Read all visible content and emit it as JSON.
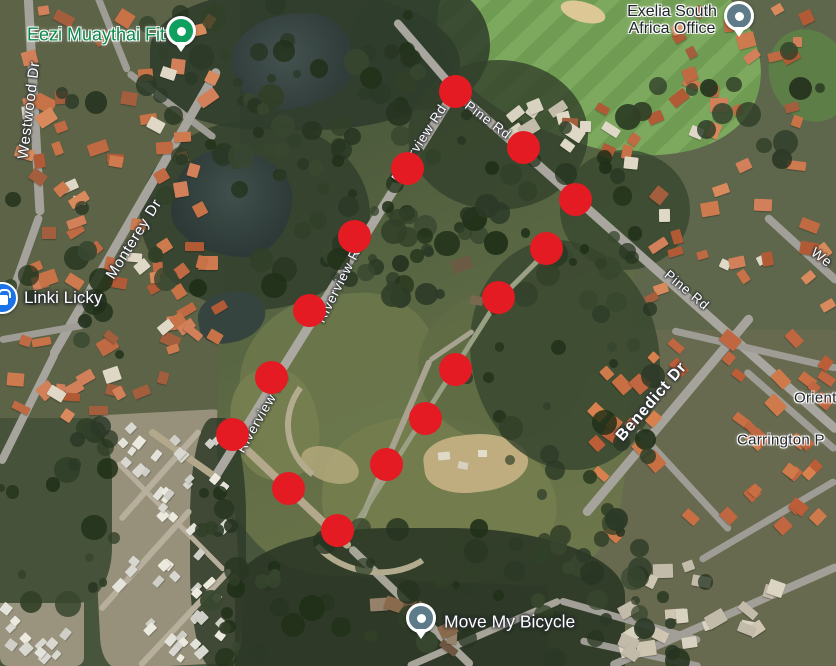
{
  "map_type": "satellite",
  "annotation": {
    "dot_color": "#e41b22",
    "dot_diameter": 33,
    "boundary_dots": [
      {
        "x": 455,
        "y": 91
      },
      {
        "x": 523,
        "y": 147
      },
      {
        "x": 575,
        "y": 199
      },
      {
        "x": 546,
        "y": 248
      },
      {
        "x": 498,
        "y": 297
      },
      {
        "x": 455,
        "y": 369
      },
      {
        "x": 425,
        "y": 418
      },
      {
        "x": 386,
        "y": 464
      },
      {
        "x": 337,
        "y": 530
      },
      {
        "x": 288,
        "y": 488
      },
      {
        "x": 232,
        "y": 434
      },
      {
        "x": 271,
        "y": 377
      },
      {
        "x": 309,
        "y": 310
      },
      {
        "x": 354,
        "y": 236
      },
      {
        "x": 407,
        "y": 168
      }
    ]
  },
  "road_labels": [
    {
      "text": "Westwood Dr",
      "x": 29,
      "y": 110,
      "rot": -83,
      "size": 15,
      "weight": 400
    },
    {
      "text": "Monterey Dr",
      "x": 134,
      "y": 239,
      "rot": -58,
      "size": 15,
      "weight": 400
    },
    {
      "text": "Riverview Rd",
      "x": 262,
      "y": 413,
      "rot": -60,
      "size": 13.5,
      "weight": 400
    },
    {
      "text": "Riverview Rd",
      "x": 340,
      "y": 282,
      "rot": -63,
      "size": 13.5,
      "weight": 400
    },
    {
      "text": "Riverview Rd",
      "x": 419,
      "y": 143,
      "rot": -57,
      "size": 13.5,
      "weight": 400
    },
    {
      "text": "Pine Rd",
      "x": 488,
      "y": 120,
      "rot": 37,
      "size": 13.5,
      "weight": 400
    },
    {
      "text": "Pine Rd",
      "x": 687,
      "y": 290,
      "rot": 40,
      "size": 13.5,
      "weight": 400
    },
    {
      "text": "Benedict Dr",
      "x": 652,
      "y": 402,
      "rot": -49,
      "size": 16,
      "weight": 600
    },
    {
      "text": "We",
      "x": 822,
      "y": 257,
      "rot": 37,
      "size": 14,
      "weight": 400
    }
  ],
  "place_labels": [
    {
      "text": "Orient",
      "x": 794,
      "y": 398,
      "size": 15
    },
    {
      "text": "Carrington P",
      "x": 737,
      "y": 440,
      "size": 15
    }
  ],
  "pois": [
    {
      "id": "eezi-muaythai-fit",
      "label": "Eezi Muaythai Fit",
      "label_color": "#0c8a4c",
      "size": 18,
      "marker": {
        "type": "pin",
        "color": "#0fa060",
        "x": 181,
        "y": 31
      },
      "label_pos": {
        "anchor": "right",
        "x": 165,
        "y": 35
      }
    },
    {
      "id": "linki-licky",
      "label": "Linki Licky",
      "label_color": "#ffffff",
      "size": 17,
      "marker": {
        "type": "circle",
        "color": "#1a73e8",
        "x": 2,
        "y": 298
      },
      "label_pos": {
        "anchor": "left",
        "x": 24,
        "y": 298
      }
    },
    {
      "id": "exelia-south-africa-office",
      "label_lines": [
        "Exelia South",
        "Africa Office"
      ],
      "label_color": "#20262b",
      "size": 16,
      "marker": {
        "type": "pin",
        "color": "#5d7b89",
        "x": 739,
        "y": 16
      },
      "label_pos": {
        "anchor": "center",
        "x": 672,
        "y": 21
      }
    },
    {
      "id": "move-my-bicycle",
      "label": "Move My Bicycle",
      "label_color": "#ffffff",
      "size": 17.5,
      "marker": {
        "type": "pin",
        "color": "#5d7b89",
        "x": 421,
        "y": 618
      },
      "label_pos": {
        "anchor": "left",
        "x": 444,
        "y": 622
      }
    }
  ]
}
